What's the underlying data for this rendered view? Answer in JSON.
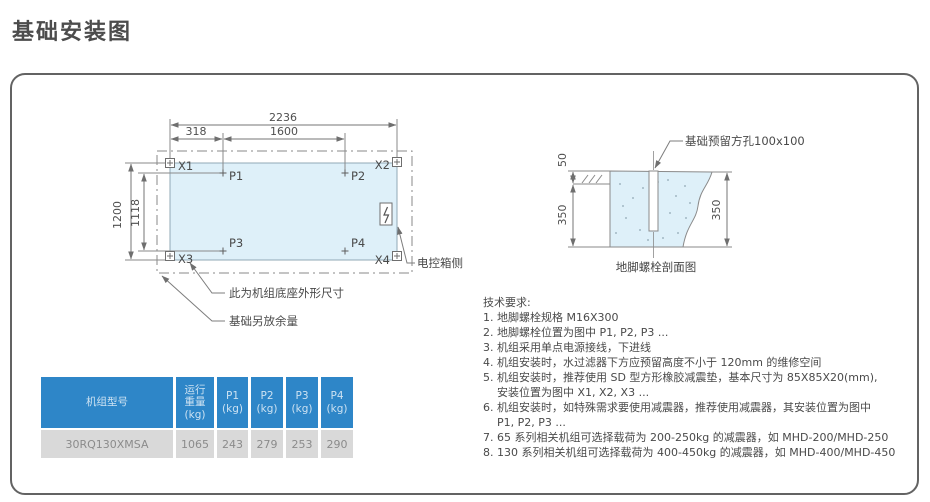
{
  "title": "基础安装图",
  "plan": {
    "dims": {
      "total_width": "2236",
      "left_offset": "318",
      "bolt_span": "1600",
      "total_height": "1200",
      "bolt_height": "1118"
    },
    "corners": [
      "X1",
      "X2",
      "X3",
      "X4"
    ],
    "bolts": [
      "P1",
      "P2",
      "P3",
      "P4"
    ],
    "labels": {
      "control_box_side": "电控箱侧",
      "base_outline": "此为机组底座外形尺寸",
      "foundation_margin": "基础另放余量"
    }
  },
  "section": {
    "hole_label": "基础预留方孔100x100",
    "dim_top": "50",
    "dim_left": "350",
    "dim_right": "350",
    "caption": "地脚螺栓剖面图"
  },
  "requirements": {
    "heading": "技术要求:",
    "lines": [
      "1. 地脚螺栓规格 M16X300",
      "2. 地脚螺栓位置为图中 P1, P2, P3 ...",
      "3. 机组采用单点电源接线，下进线",
      "4. 机组安装时，水过滤器下方应预留高度不小于 120mm 的维修空间",
      "5. 机组安装时，推荐使用 SD 型方形橡胶减震垫，基本尺寸为 85X85X20(mm),",
      "安装位置为图中 X1, X2, X3 ...",
      "6. 机组安装时，如特殊需求要使用减震器，推荐使用减震器，其安装位置为图中",
      "P1, P2, P3 ...",
      "7. 65 系列相关机组可选择载荷为 200-250kg 的减震器，如 MHD-200/MHD-250",
      "8. 130 系列相关机组可选择载荷为 400-450kg 的减震器，如 MHD-400/MHD-450"
    ]
  },
  "table": {
    "headers": {
      "model": "机组型号",
      "weight": [
        "运行",
        "重量",
        "(kg)"
      ],
      "p1": [
        "P1",
        "(kg)"
      ],
      "p2": [
        "P2",
        "(kg)"
      ],
      "p3": [
        "P3",
        "(kg)"
      ],
      "p4": [
        "P4",
        "(kg)"
      ]
    },
    "row": {
      "model": "30RQ130XMSA",
      "weight": "1065",
      "p1": "243",
      "p2": "279",
      "p3": "253",
      "p4": "290"
    }
  },
  "colors": {
    "accent_blue": "#2e86c8",
    "diagram_fill": "#def0f9",
    "row_gray": "#d9d9d9",
    "line_gray": "#8a8a8a"
  }
}
